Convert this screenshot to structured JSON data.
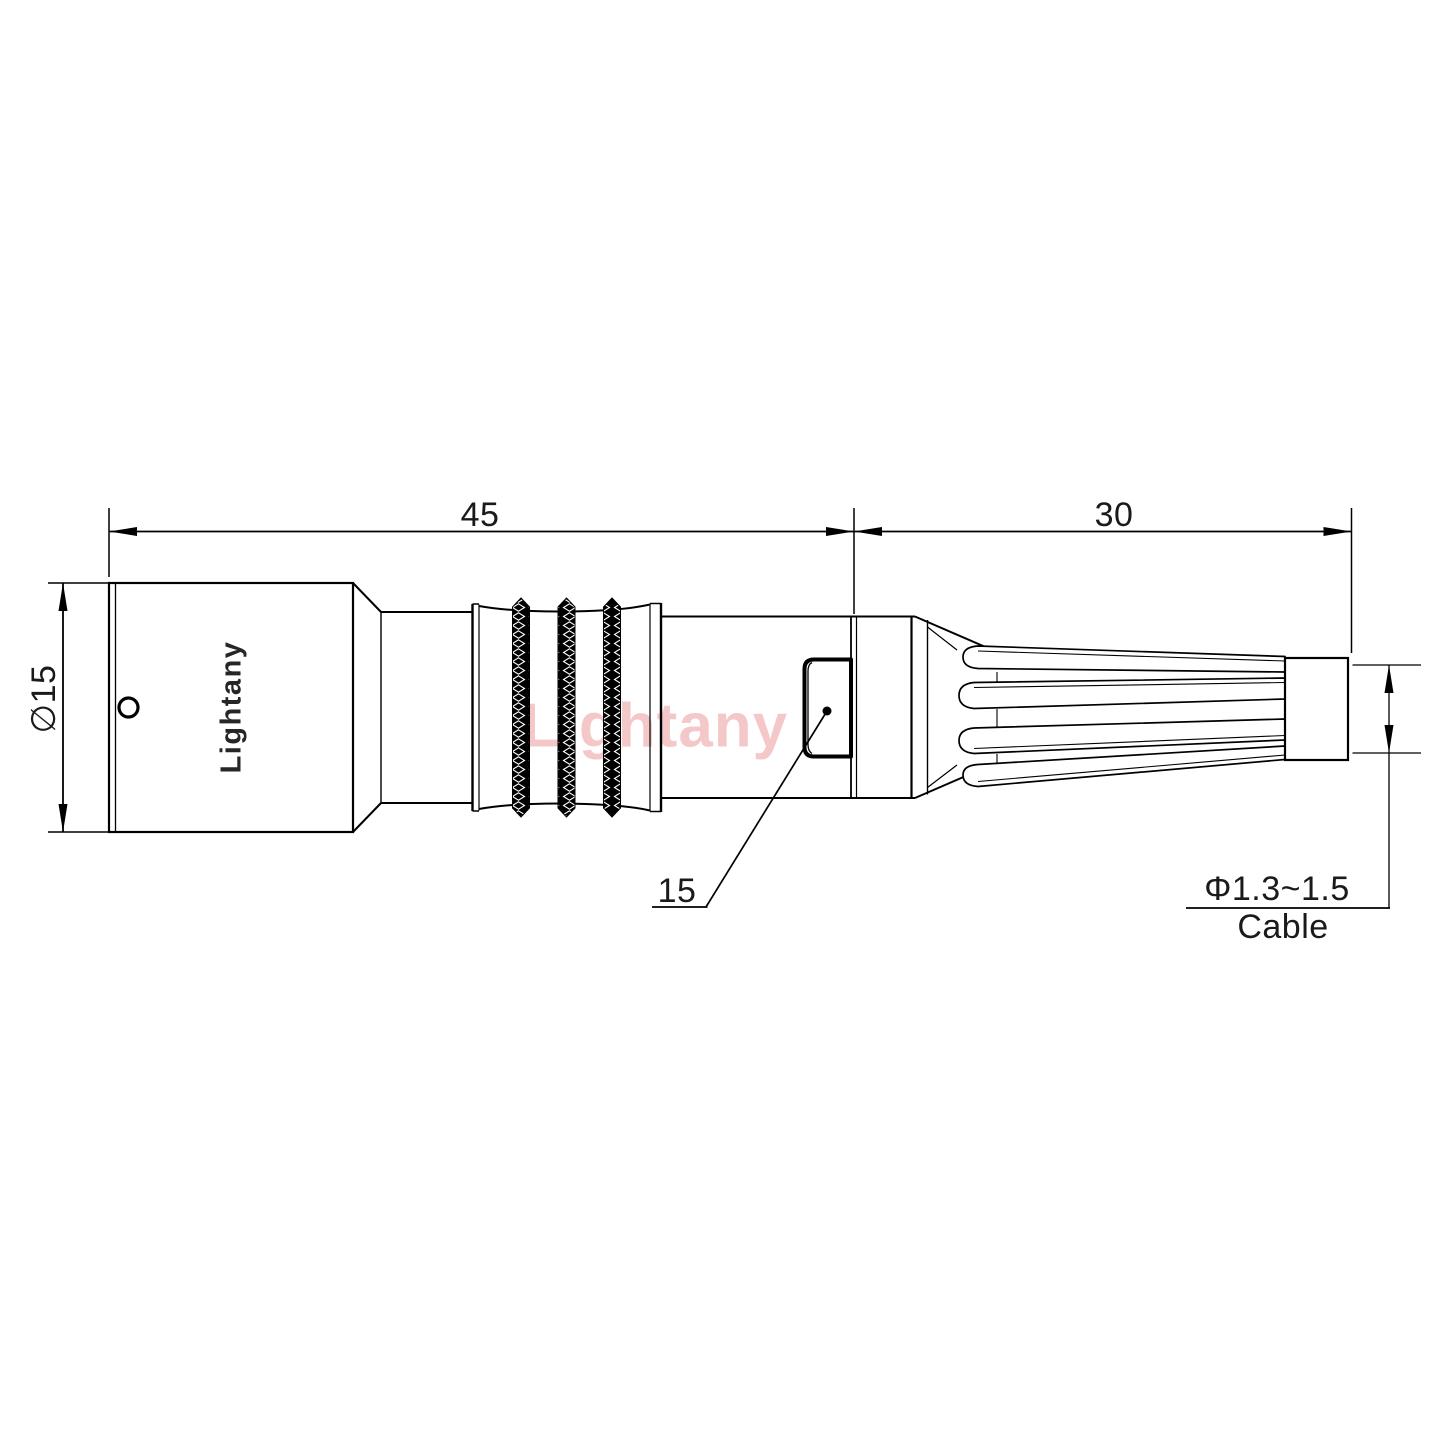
{
  "drawing": {
    "watermark": "Lightany",
    "body_logo": "Lightany",
    "dimensions": {
      "main_length": "45",
      "boot_length": "30",
      "body_diameter": "∅15",
      "nut_ref": "15",
      "cable_range": "Φ1.3~1.5",
      "cable_label": "Cable"
    },
    "colors": {
      "line": "#000000",
      "background": "#ffffff",
      "watermark_pink": "#f0b3b3",
      "logo_text": "#262626"
    }
  }
}
